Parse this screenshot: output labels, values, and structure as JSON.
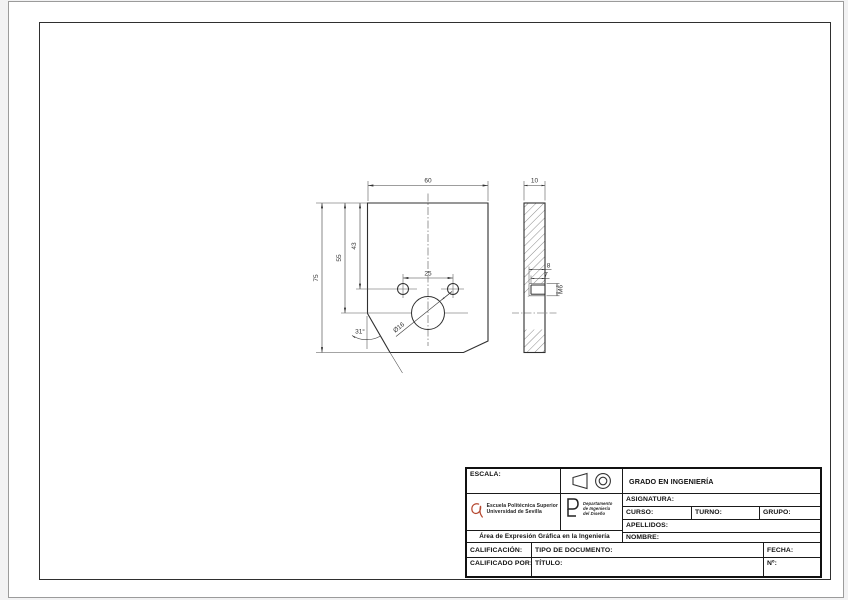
{
  "colors": {
    "line": "#2f2f2f",
    "logo_accent": "#b5472f"
  },
  "drawing": {
    "front": {
      "width": "60",
      "height": "75",
      "to_big_hole": "55",
      "to_small_holes": "43",
      "holes_spacing": "25",
      "big_hole_diameter": "Ø16",
      "chamfer_angle": "31°"
    },
    "side": {
      "thickness": "10",
      "drill_depth": "8",
      "thread_depth": "7",
      "thread_size": "M6"
    }
  },
  "title_block": {
    "escala_label": "ESCALA:",
    "grado": "GRADO EN INGENIERÍA",
    "asignatura_label": "ASIGNATURA:",
    "curso_label": "CURSO:",
    "turno_label": "TURNO:",
    "grupo_label": "GRUPO:",
    "apellidos_label": "APELLIDOS:",
    "nombre_label": "NOMBRE:",
    "area_line": "Área de Expresión Gráfica en la Ingeniería",
    "calificacion_label": "CALIFICACIÓN:",
    "tipo_documento_label": "TIPO DE DOCUMENTO:",
    "fecha_label": "FECHA:",
    "calificado_por_label": "CALIFICADO POR:",
    "titulo_label": "TÍTULO:",
    "numero_label": "Nº:",
    "eps_name_line1": "Escuela Politécnica Superior",
    "eps_name_line2": "Universidad de Sevilla",
    "dept_line1": "Departamento",
    "dept_line2": "de Ingeniería",
    "dept_line3": "del Diseño"
  }
}
